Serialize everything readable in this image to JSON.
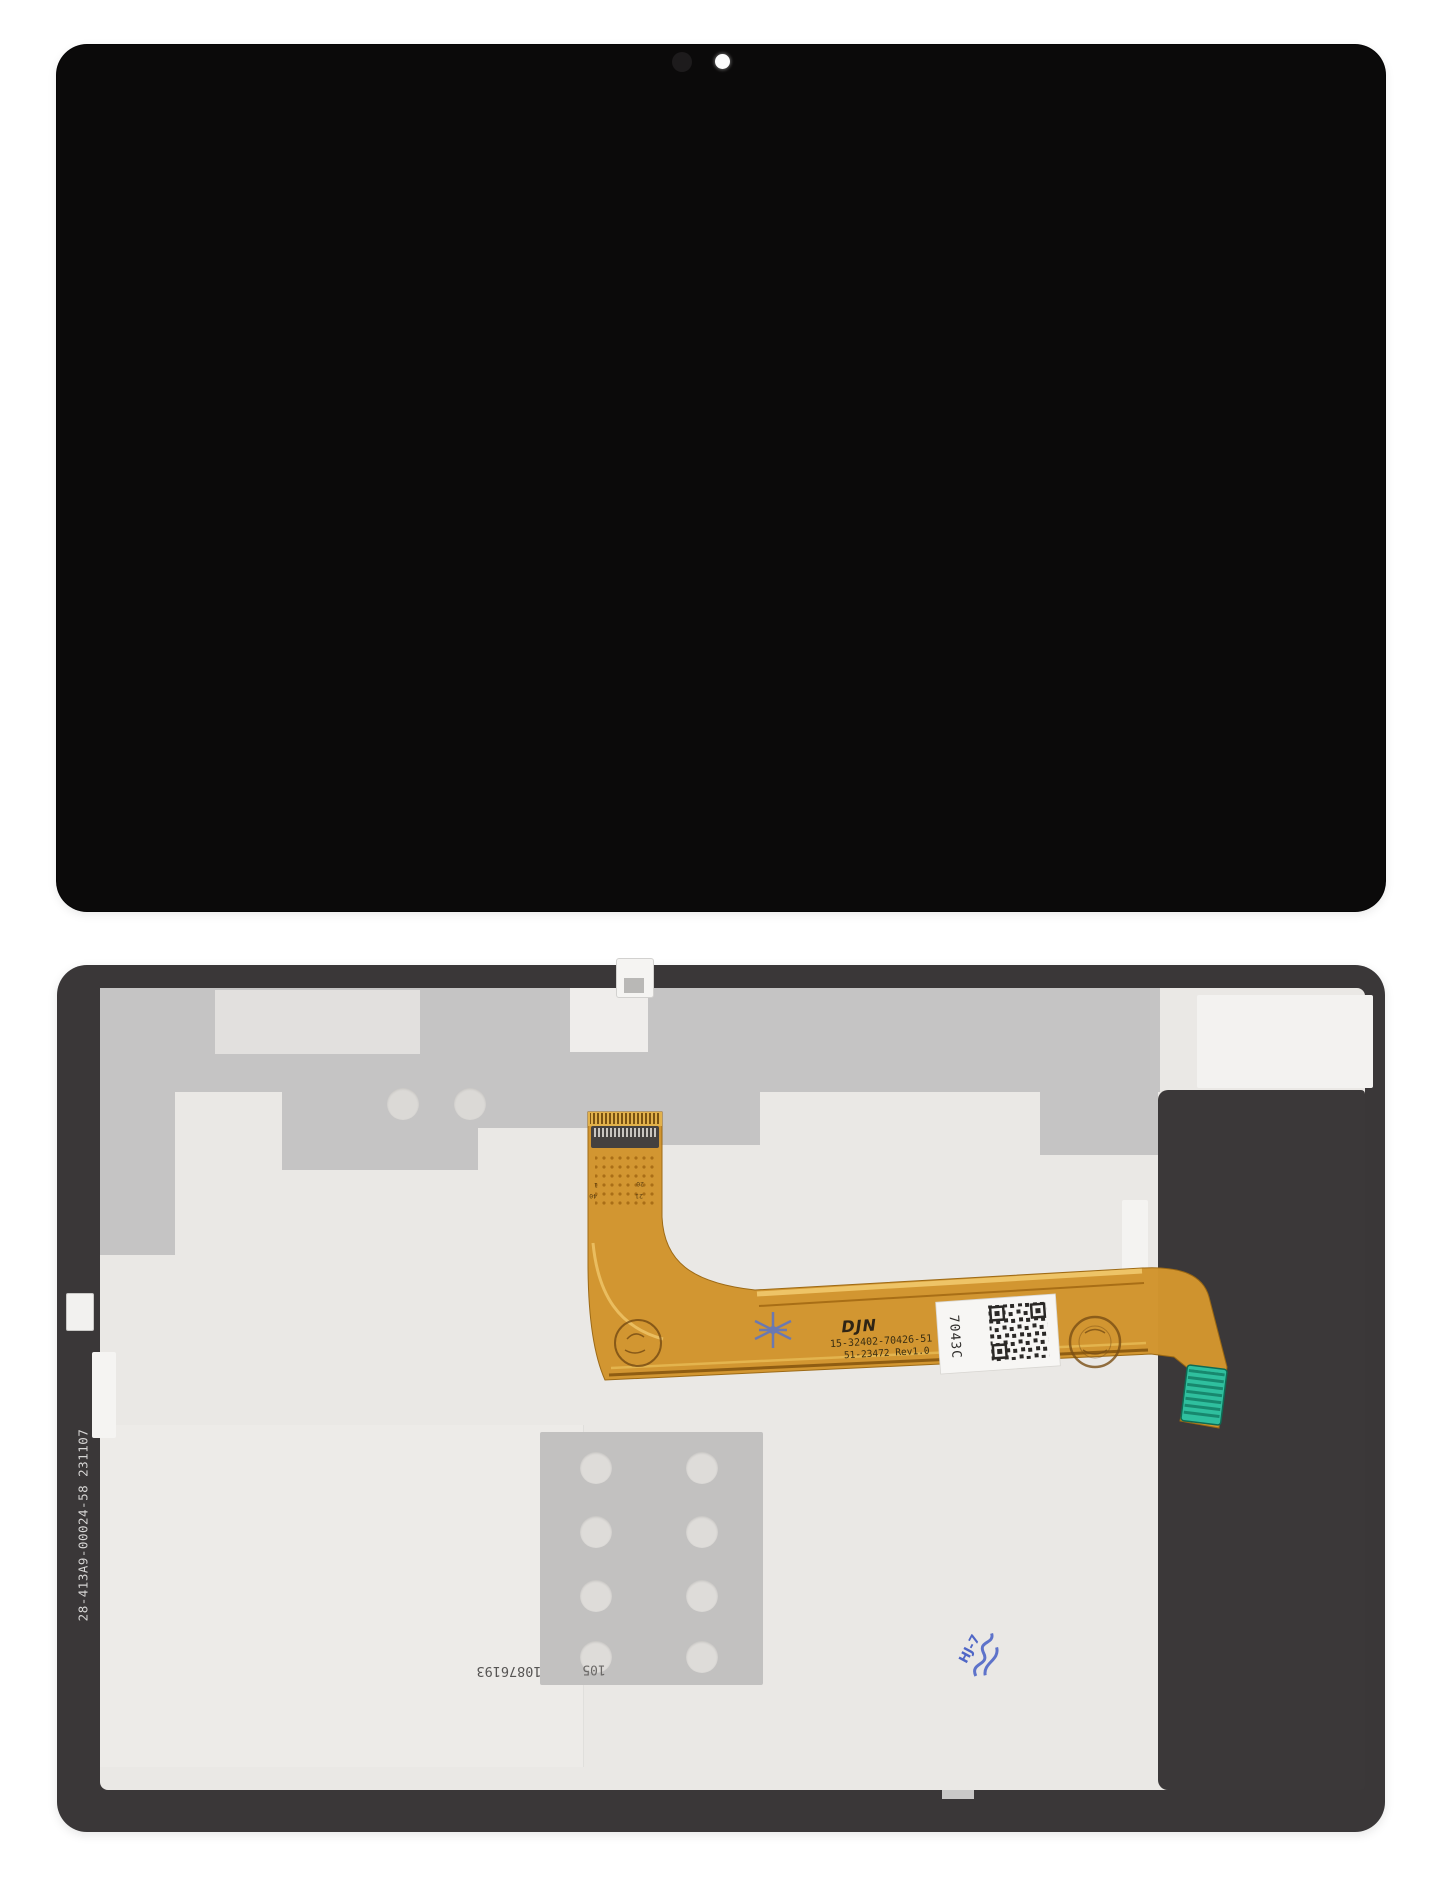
{
  "flex_cable": {
    "brand": "DJN",
    "part_number": "15-32402-70426-51",
    "revision_code": "51-23472 Rev1.0",
    "label_code": "7043C",
    "pin_labels": [
      "1",
      "40",
      "20",
      "21"
    ]
  },
  "back_panel": {
    "edge_code": "28-413A9-00024-58 231107",
    "serial_code": "10876193",
    "serial_fragment": "105",
    "blue_stamp_code": "HJ-7"
  },
  "colors": {
    "front_black": "#0b0a0a",
    "bezel_dark": "#3a3738",
    "panel_silver": "#eae8e5",
    "patch_gray": "#c5c4c4",
    "cable_orange": "#d2952e",
    "cable_highlight": "#eec467",
    "teal_connector": "#2fbf9e",
    "label_white": "#f7f6f4",
    "stamp_blue": "#4f66c6"
  }
}
